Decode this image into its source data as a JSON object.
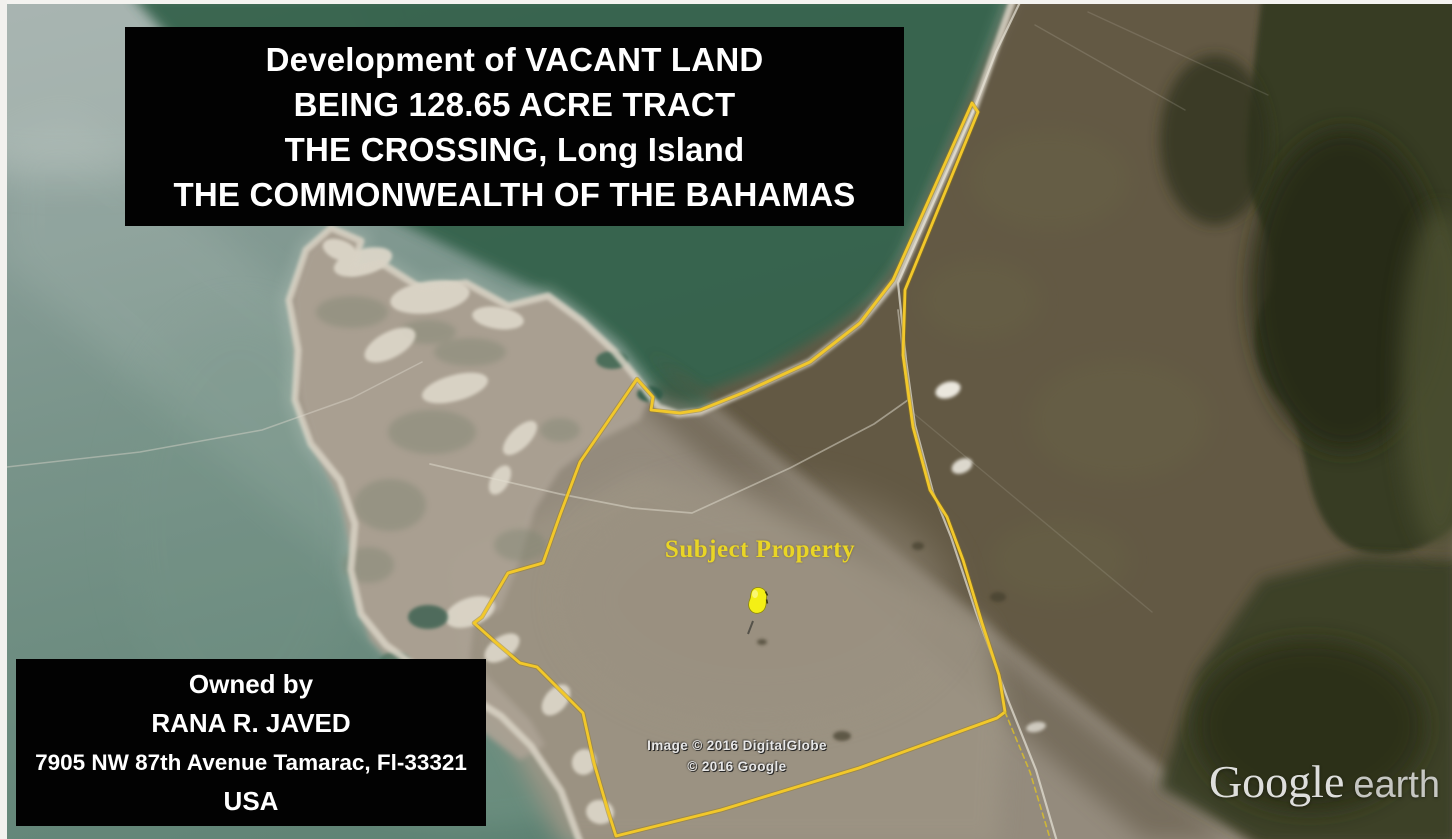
{
  "title_box": {
    "lines": [
      "Development of VACANT LAND",
      "BEING 128.65 ACRE TRACT",
      "THE CROSSING, Long Island",
      "THE COMMONWEALTH OF THE BAHAMAS"
    ]
  },
  "owner_box": {
    "lines": [
      "Owned by",
      "RANA R. JAVED",
      "7905 NW 87th Avenue Tamarac, Fl-33321",
      "USA"
    ]
  },
  "map": {
    "subject_property_label": "Subject Property",
    "marker_icon": "yellow-pushpin-icon",
    "boundary_color": "#f2c82a",
    "label_color": "#e9d526"
  },
  "attribution": {
    "line1": "Image © 2016 DigitalGlobe",
    "line2": "© 2016 Google"
  },
  "logo": {
    "brand": "Google",
    "product": "earth"
  }
}
